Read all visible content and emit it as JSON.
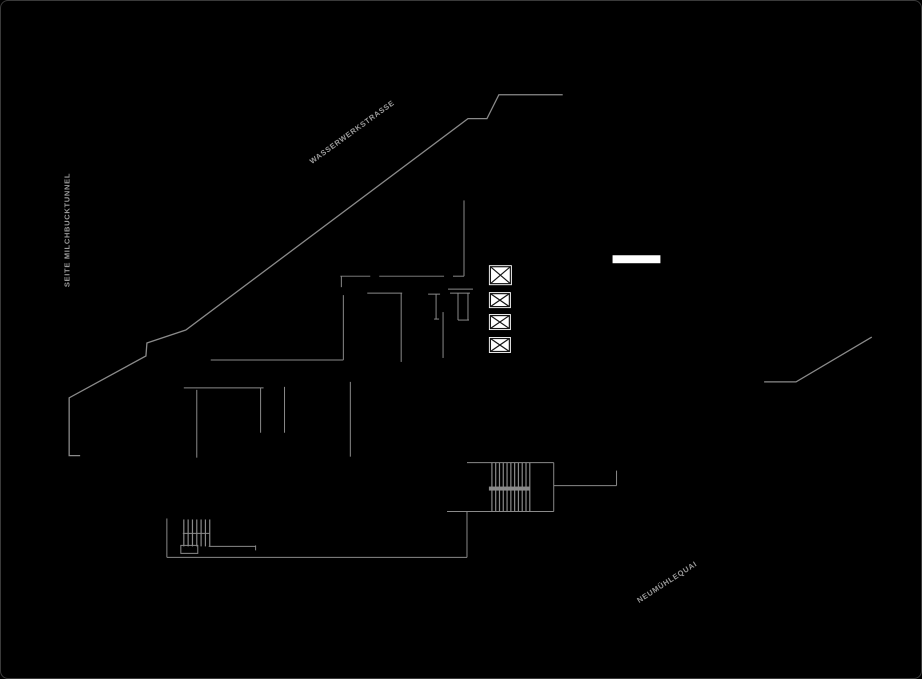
{
  "canvas": {
    "width": 922,
    "height": 679,
    "background": "#000000",
    "border_color": "#3a3a3a",
    "line_color": "#8a8a8a",
    "symbol_stroke": "#141414",
    "white": "#ffffff",
    "label_color": "#9a9a9a"
  },
  "labels": [
    {
      "id": "wasserwerkstrasse",
      "text": "WASSERWERKSTRASSE",
      "x": 351,
      "y": 131,
      "rotation": -36
    },
    {
      "id": "milchbucktunnel",
      "text": "SEITE MILCHBUCKTUNNEL",
      "x": 66,
      "y": 229,
      "rotation": -90
    },
    {
      "id": "neumuehlequai",
      "text": "NEUMÜHLEQUAI",
      "x": 666,
      "y": 581,
      "rotation": -33
    }
  ],
  "plan": {
    "elements": [
      {
        "type": "polyline",
        "name": "road-edge-wasserwerkstrasse",
        "width": 1.3,
        "points": [
          [
            563,
            94
          ],
          [
            499,
            94
          ],
          [
            487,
            118
          ],
          [
            468,
            118
          ],
          [
            185,
            330
          ],
          [
            146,
            343
          ],
          [
            145,
            356
          ],
          [
            68,
            398
          ],
          [
            68,
            456
          ],
          [
            79,
            456
          ]
        ]
      },
      {
        "type": "polyline",
        "name": "road-edge-neumuehlequai",
        "width": 1.3,
        "points": [
          [
            765,
            382
          ],
          [
            797,
            382
          ],
          [
            873,
            337
          ]
        ]
      },
      {
        "type": "line",
        "name": "wall-line",
        "x1": 340,
        "y1": 276,
        "x2": 370,
        "y2": 276
      },
      {
        "type": "line",
        "name": "wall-line",
        "x1": 379,
        "y1": 276,
        "x2": 444,
        "y2": 276
      },
      {
        "type": "line",
        "name": "wall-line",
        "x1": 453,
        "y1": 276,
        "x2": 464,
        "y2": 276
      },
      {
        "type": "line",
        "name": "wall-line",
        "x1": 464,
        "y1": 200,
        "x2": 464,
        "y2": 276
      },
      {
        "type": "line",
        "name": "wall-line",
        "x1": 341,
        "y1": 276,
        "x2": 341,
        "y2": 287
      },
      {
        "type": "line",
        "name": "wall-line",
        "x1": 343,
        "y1": 295,
        "x2": 343,
        "y2": 360
      },
      {
        "type": "line",
        "name": "wall-line",
        "x1": 367,
        "y1": 293,
        "x2": 402,
        "y2": 293
      },
      {
        "type": "line",
        "name": "wall-line",
        "x1": 401,
        "y1": 293,
        "x2": 401,
        "y2": 362
      },
      {
        "type": "line",
        "name": "wall-line",
        "x1": 210,
        "y1": 360,
        "x2": 343,
        "y2": 360
      },
      {
        "type": "line",
        "name": "wall-line",
        "x1": 183,
        "y1": 388,
        "x2": 263,
        "y2": 388
      },
      {
        "type": "line",
        "name": "wall-line",
        "x1": 196,
        "y1": 390,
        "x2": 196,
        "y2": 458
      },
      {
        "type": "line",
        "name": "wall-line",
        "x1": 260,
        "y1": 388,
        "x2": 260,
        "y2": 433
      },
      {
        "type": "line",
        "name": "wall-line",
        "x1": 284,
        "y1": 387,
        "x2": 284,
        "y2": 433
      },
      {
        "type": "line",
        "name": "wall-line",
        "x1": 350,
        "y1": 382,
        "x2": 350,
        "y2": 457
      },
      {
        "type": "line",
        "name": "wall-line",
        "x1": 443,
        "y1": 312,
        "x2": 443,
        "y2": 358
      },
      {
        "type": "line",
        "name": "wall-line",
        "x1": 448,
        "y1": 289,
        "x2": 473,
        "y2": 289
      },
      {
        "type": "line",
        "name": "door-symbol",
        "x1": 428,
        "y1": 294,
        "x2": 440,
        "y2": 294
      },
      {
        "type": "line",
        "name": "door-symbol",
        "x1": 436,
        "y1": 294,
        "x2": 436,
        "y2": 319
      },
      {
        "type": "line",
        "name": "door-symbol",
        "x1": 434,
        "y1": 319,
        "x2": 439,
        "y2": 319
      },
      {
        "type": "line",
        "name": "door-frame-symbol",
        "x1": 450,
        "y1": 293,
        "x2": 470,
        "y2": 293
      },
      {
        "type": "line",
        "name": "door-frame-symbol",
        "x1": 458,
        "y1": 293,
        "x2": 458,
        "y2": 320
      },
      {
        "type": "line",
        "name": "door-frame-symbol",
        "x1": 468,
        "y1": 293,
        "x2": 468,
        "y2": 320
      },
      {
        "type": "line",
        "name": "door-frame-symbol",
        "x1": 458,
        "y1": 320,
        "x2": 469,
        "y2": 320
      },
      {
        "type": "line",
        "name": "stair-enclosure",
        "x1": 467,
        "y1": 463,
        "x2": 554,
        "y2": 463
      },
      {
        "type": "line",
        "name": "stair-enclosure",
        "x1": 554,
        "y1": 463,
        "x2": 554,
        "y2": 512
      },
      {
        "type": "line",
        "name": "stair-enclosure",
        "x1": 447,
        "y1": 512,
        "x2": 554,
        "y2": 512
      },
      {
        "type": "hatch",
        "name": "stair-treads",
        "x1": 492,
        "x2": 530,
        "y1": 463,
        "y2": 512,
        "count": 11
      },
      {
        "type": "bar",
        "name": "stair-landing-bar",
        "x": 489,
        "y": 487,
        "w": 41,
        "h": 4,
        "fill": "line"
      },
      {
        "type": "line",
        "name": "wall-line",
        "x1": 554,
        "y1": 486,
        "x2": 617,
        "y2": 486
      },
      {
        "type": "line",
        "name": "wall-line",
        "x1": 617,
        "y1": 471,
        "x2": 617,
        "y2": 486
      },
      {
        "type": "line",
        "name": "boundary-line",
        "x1": 166,
        "y1": 519,
        "x2": 166,
        "y2": 558
      },
      {
        "type": "line",
        "name": "boundary-line",
        "x1": 166,
        "y1": 558,
        "x2": 467,
        "y2": 558
      },
      {
        "type": "line",
        "name": "boundary-line",
        "x1": 467,
        "y1": 512,
        "x2": 467,
        "y2": 558
      },
      {
        "type": "line",
        "name": "wall-line",
        "x1": 208,
        "y1": 547,
        "x2": 255,
        "y2": 547
      },
      {
        "type": "line",
        "name": "wall-line",
        "x1": 255,
        "y1": 546,
        "x2": 255,
        "y2": 551
      },
      {
        "type": "hatch",
        "name": "small-stair-treads",
        "x1": 183,
        "x2": 209,
        "y1": 520,
        "y2": 547,
        "count": 7
      },
      {
        "type": "line",
        "name": "small-stair-landing-line",
        "x1": 182,
        "y1": 534,
        "x2": 209,
        "y2": 534
      },
      {
        "type": "rect",
        "name": "small-stair-landing",
        "x": 180,
        "y": 546,
        "w": 17,
        "h": 8
      },
      {
        "type": "bar",
        "name": "white-marker-bar",
        "x": 613,
        "y": 255,
        "w": 48,
        "h": 8,
        "fill": "white"
      },
      {
        "type": "xbox",
        "name": "shaft-symbol",
        "x": 489,
        "y": 265,
        "w": 23,
        "h": 20
      },
      {
        "type": "xbox",
        "name": "shaft-symbol",
        "x": 489,
        "y": 292,
        "w": 22,
        "h": 16
      },
      {
        "type": "xbox",
        "name": "shaft-symbol",
        "x": 489,
        "y": 314,
        "w": 22,
        "h": 16
      },
      {
        "type": "xbox",
        "name": "shaft-symbol",
        "x": 489,
        "y": 337,
        "w": 22,
        "h": 16
      }
    ]
  }
}
